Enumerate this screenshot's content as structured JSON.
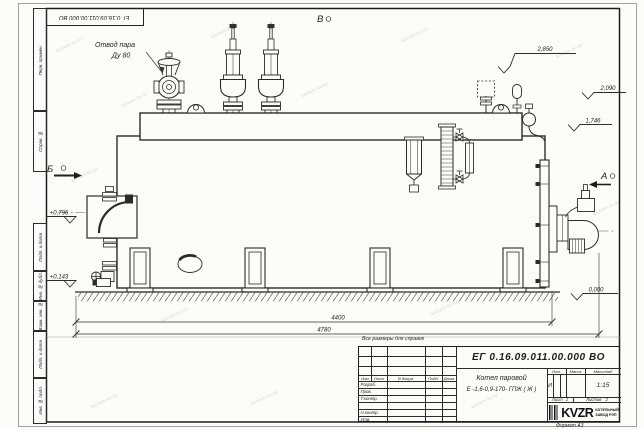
{
  "corner_stamp": {
    "doc_number": "ЕГ 0.16.09.011.00.000  ВО"
  },
  "margin": {
    "labels": [
      "Перв. примен.",
      "Справ. №",
      "Подп. и дата",
      "Инв. № дубл.",
      "Взам. инв. №",
      "Подп. и дата",
      "Инв. № подл."
    ]
  },
  "drawing": {
    "note": "Все размеры для справок",
    "steam_outlet": {
      "line1": "Отвод пара",
      "line2": "Ду 80"
    },
    "views": {
      "A": "А",
      "B": "Б",
      "V": "В"
    },
    "elevations": {
      "top": "2,850",
      "upper": "2,090",
      "platform": "1,746",
      "ground": "0,000",
      "door": "+0,796",
      "lower": "+0,143"
    },
    "dimensions": {
      "length_main": "4400",
      "length_overall": "4780"
    }
  },
  "title_block": {
    "doc_number": "ЕГ 0.16.09.011.00.000  ВО",
    "name_line1": "Котел паровой",
    "name_line2": "Е -1,6-0,9-170- ГПЖ ( Ж )",
    "col_headers": {
      "izm": "Изм",
      "list": "Лист",
      "doc": "N докум.",
      "podp": "Подп.",
      "date": "Дата"
    },
    "row_labels": {
      "razrab": "Разраб.",
      "prov": "Пров.",
      "tkontr": "Т.контр.",
      "nkontr": "Н.контр.",
      "utv": "Утв."
    },
    "props": {
      "lit_label": "Лит.",
      "mass_label": "Масса",
      "scale_label": "Масштаб",
      "lit_value": "И",
      "scale_value": "1:15"
    },
    "sheets": {
      "sheet_label": "Лист",
      "sheet_value": "1",
      "total_label": "Листов",
      "total_value": "2"
    },
    "logo": {
      "name": "KVZR",
      "tagline1": "КОТЕЛЬНЫЙ",
      "tagline2": "ЗАВОД РЭП"
    },
    "format_label": "Формат А3"
  },
  "watermark": {
    "text": "kotlam-kv.kz"
  }
}
